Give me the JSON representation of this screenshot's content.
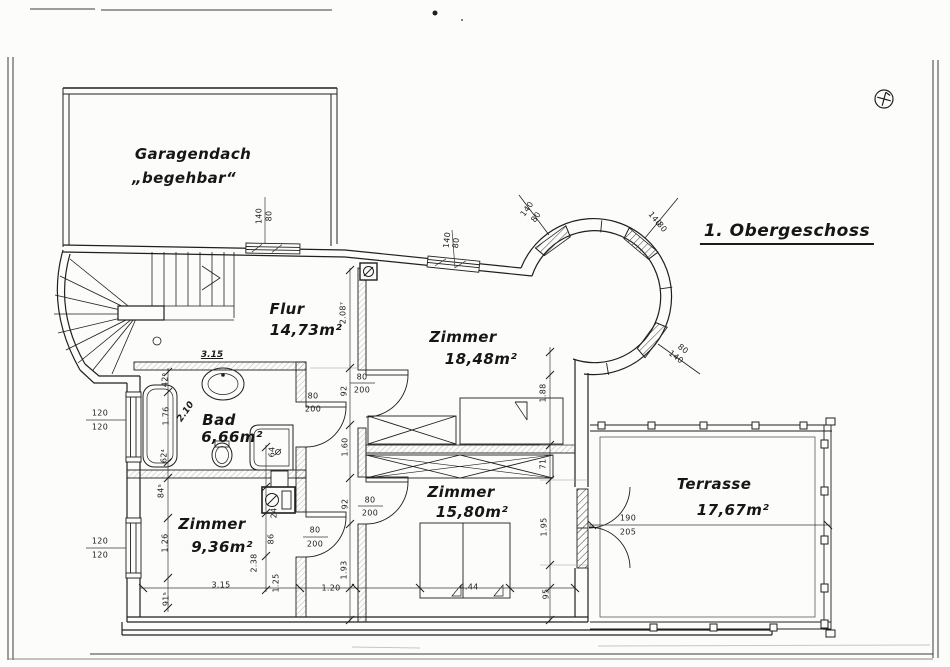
{
  "page": {
    "title": "1. Obergeschoss",
    "paper_color": "#fcfcfb",
    "ink_color": "#1f1f1f",
    "marker_icon": "circled-cross-plan-marker"
  },
  "rooms": [
    {
      "name": "Garagendach",
      "note": "„begehbar“"
    },
    {
      "name": "Flur",
      "area": "14,73m²"
    },
    {
      "name": "Zimmer",
      "area": "18,48m²"
    },
    {
      "name": "Bad",
      "area": "6,66m²"
    },
    {
      "name": "Zimmer",
      "area": "9,36m²"
    },
    {
      "name": "Zimmer",
      "area": "15,80m²"
    },
    {
      "name": "Terrasse",
      "area": "17,67m²"
    }
  ],
  "window_sizes": [
    "140/80",
    "120/120"
  ],
  "door_sizes": [
    "80/200",
    "190/205"
  ],
  "annotations": [
    {
      "text": "Garagendach",
      "x": 193,
      "y": 154,
      "cls": "hand",
      "name": "room-label-garagendach"
    },
    {
      "text": "„begehbar“",
      "x": 184,
      "y": 178,
      "cls": "hand",
      "name": "room-note-begehbar"
    },
    {
      "text": "1. Obergeschoss",
      "x": 787,
      "y": 233,
      "cls": "hand-title",
      "name": "floor-title"
    },
    {
      "text": "Flur",
      "x": 287,
      "y": 309,
      "cls": "hand",
      "name": "room-label-flur"
    },
    {
      "text": "14,73m²",
      "x": 306,
      "y": 330,
      "cls": "hand",
      "name": "area-flur"
    },
    {
      "text": "Zimmer",
      "x": 463,
      "y": 337,
      "cls": "hand",
      "name": "room-label-zimmer-1848"
    },
    {
      "text": "18,48m²",
      "x": 481,
      "y": 359,
      "cls": "hand",
      "name": "area-zimmer-1848"
    },
    {
      "text": "Bad",
      "x": 219,
      "y": 420,
      "cls": "hand",
      "name": "room-label-bad"
    },
    {
      "text": "6,66m²",
      "x": 232,
      "y": 437,
      "cls": "hand",
      "name": "area-bad"
    },
    {
      "text": "Zimmer",
      "x": 212,
      "y": 524,
      "cls": "hand",
      "name": "room-label-zimmer-936"
    },
    {
      "text": "9,36m²",
      "x": 222,
      "y": 547,
      "cls": "hand",
      "name": "area-zimmer-936"
    },
    {
      "text": "Zimmer",
      "x": 461,
      "y": 492,
      "cls": "hand",
      "name": "room-label-zimmer-1580"
    },
    {
      "text": "15,80m²",
      "x": 472,
      "y": 512,
      "cls": "hand",
      "name": "area-zimmer-1580"
    },
    {
      "text": "Terrasse",
      "x": 714,
      "y": 484,
      "cls": "hand",
      "name": "room-label-terrasse"
    },
    {
      "text": "17,67m²",
      "x": 733,
      "y": 510,
      "cls": "hand",
      "name": "area-terrasse"
    },
    {
      "text": "3.15",
      "x": 212,
      "y": 355,
      "cls": "hand-dim",
      "name": "hand-dim-315"
    },
    {
      "text": "2.10",
      "x": 186,
      "y": 412,
      "rot": -55,
      "cls": "hand-dim2",
      "name": "hand-dim-210"
    },
    {
      "text": "140",
      "x": 259,
      "y": 216,
      "rot": -90
    },
    {
      "text": "80",
      "x": 269,
      "y": 216,
      "rot": -90
    },
    {
      "text": "140",
      "x": 447,
      "y": 240,
      "rot": -83
    },
    {
      "text": "80",
      "x": 456,
      "y": 243,
      "rot": -83
    },
    {
      "text": "140",
      "x": 527,
      "y": 209,
      "rot": -54
    },
    {
      "text": "80",
      "x": 536,
      "y": 217,
      "rot": -54
    },
    {
      "text": "140",
      "x": 655,
      "y": 219,
      "rot": 51
    },
    {
      "text": "80",
      "x": 662,
      "y": 227,
      "rot": 51
    },
    {
      "text": "140",
      "x": 676,
      "y": 357,
      "rot": 37
    },
    {
      "text": "80",
      "x": 683,
      "y": 349,
      "rot": 37
    },
    {
      "text": "2.08⁷",
      "x": 343,
      "y": 313,
      "rot": -90
    },
    {
      "text": "92",
      "x": 344,
      "y": 391,
      "rot": -90
    },
    {
      "text": "1.60",
      "x": 345,
      "y": 447,
      "rot": -90
    },
    {
      "text": "92",
      "x": 345,
      "y": 504,
      "rot": -90
    },
    {
      "text": "1.93",
      "x": 344,
      "y": 570,
      "rot": -90
    },
    {
      "text": "1.88",
      "x": 543,
      "y": 393,
      "rot": -90
    },
    {
      "text": "71",
      "x": 543,
      "y": 464,
      "rot": -90
    },
    {
      "text": "1.95",
      "x": 544,
      "y": 527,
      "rot": -90
    },
    {
      "text": "95",
      "x": 546,
      "y": 594,
      "rot": -90
    },
    {
      "text": "42⁶",
      "x": 165,
      "y": 380,
      "rot": -90
    },
    {
      "text": "1.76",
      "x": 166,
      "y": 416,
      "rot": -90
    },
    {
      "text": "62⁴",
      "x": 164,
      "y": 456,
      "rot": -90
    },
    {
      "text": "84⁵",
      "x": 161,
      "y": 491,
      "rot": -90
    },
    {
      "text": "1.26",
      "x": 165,
      "y": 543,
      "rot": -90
    },
    {
      "text": "91⁵",
      "x": 166,
      "y": 599,
      "rot": -90
    },
    {
      "text": "64",
      "x": 272,
      "y": 452,
      "rot": -90
    },
    {
      "text": "24",
      "x": 274,
      "y": 513,
      "rot": -90
    },
    {
      "text": "86",
      "x": 271,
      "y": 539,
      "rot": -90
    },
    {
      "text": "2.38",
      "x": 254,
      "y": 563,
      "rot": -90
    },
    {
      "text": "3.15",
      "x": 221,
      "y": 585
    },
    {
      "text": "1.25",
      "x": 276,
      "y": 583,
      "rot": -90
    },
    {
      "text": "1.20",
      "x": 331,
      "y": 588
    },
    {
      "text": "4.44",
      "x": 469,
      "y": 587
    },
    {
      "text": "120",
      "x": 100,
      "y": 413
    },
    {
      "text": "120",
      "x": 100,
      "y": 427
    },
    {
      "text": "120",
      "x": 100,
      "y": 541
    },
    {
      "text": "120",
      "x": 100,
      "y": 555
    },
    {
      "text": "80",
      "x": 313,
      "y": 396
    },
    {
      "text": "200",
      "x": 313,
      "y": 409
    },
    {
      "text": "80",
      "x": 362,
      "y": 377
    },
    {
      "text": "200",
      "x": 362,
      "y": 390
    },
    {
      "text": "80",
      "x": 370,
      "y": 500
    },
    {
      "text": "200",
      "x": 370,
      "y": 513
    },
    {
      "text": "80",
      "x": 315,
      "y": 530
    },
    {
      "text": "200",
      "x": 315,
      "y": 544
    },
    {
      "text": "190",
      "x": 628,
      "y": 518
    },
    {
      "text": "205",
      "x": 628,
      "y": 532
    }
  ]
}
